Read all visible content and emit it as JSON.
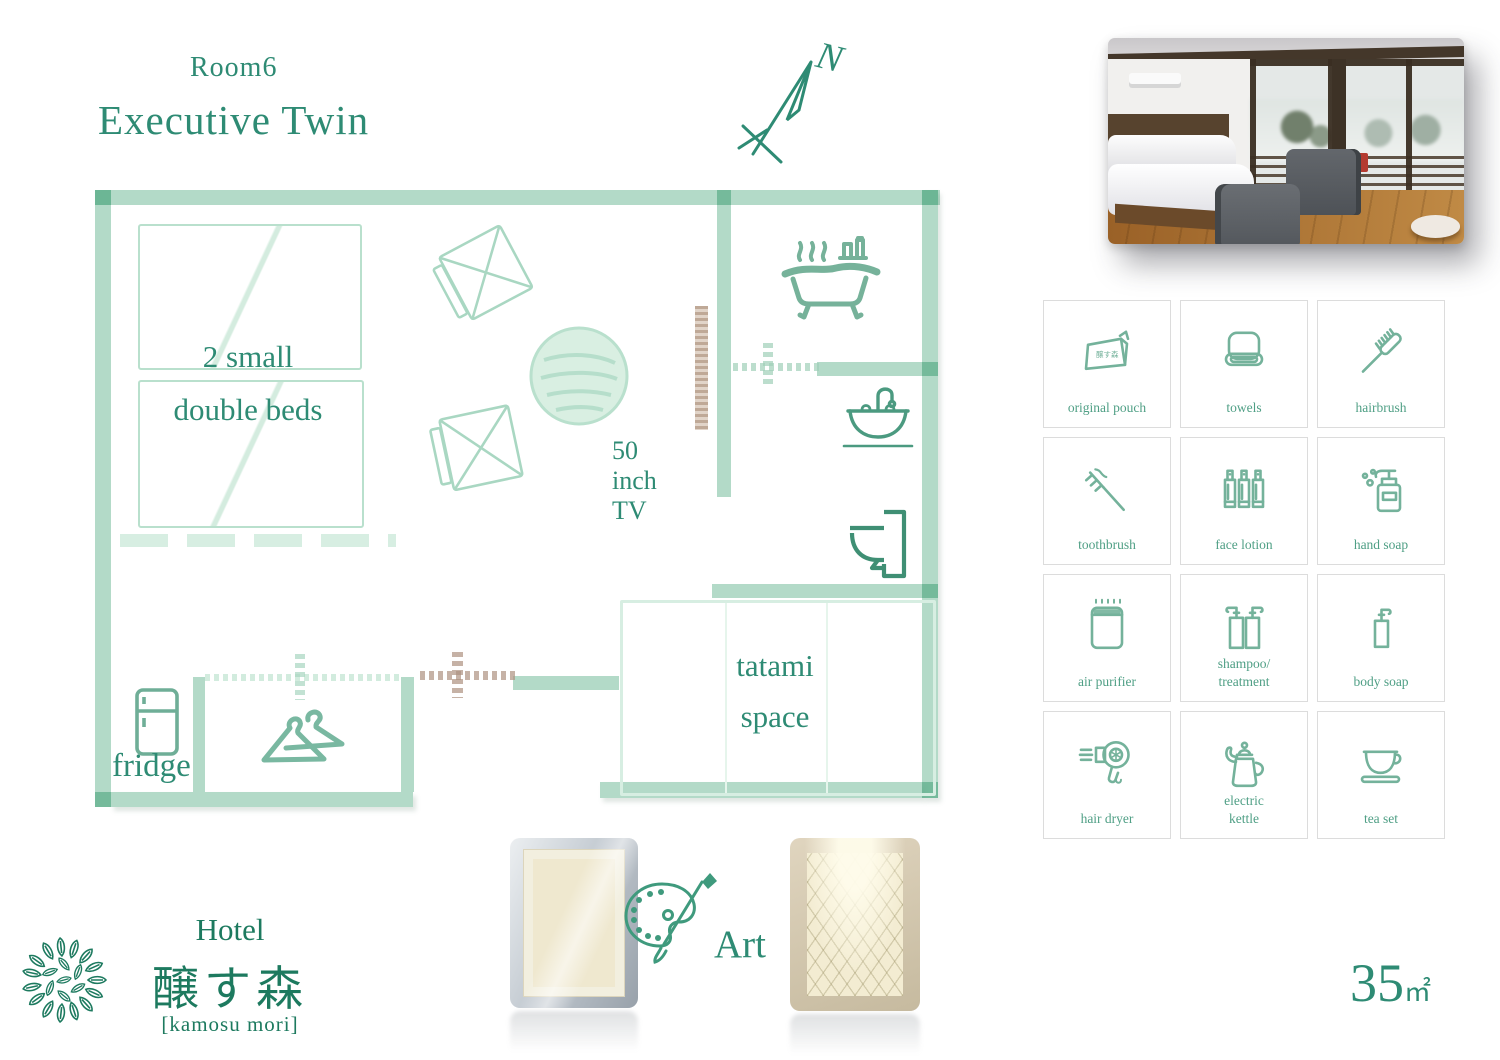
{
  "header": {
    "room_number": "Room6",
    "room_type": "Executive Twin"
  },
  "compass": {
    "north_label": "N"
  },
  "floorplan": {
    "beds_label": "2 small\ndouble beds",
    "tv_label": "50 inch TV",
    "tatami_label": "tatami\nspace",
    "fridge_label": "fridge"
  },
  "amenities": [
    {
      "label": "original pouch",
      "icon_text": "醸す森"
    },
    {
      "label": "towels"
    },
    {
      "label": "hairbrush"
    },
    {
      "label": "toothbrush"
    },
    {
      "label": "face lotion"
    },
    {
      "label": "hand soap"
    },
    {
      "label": "air purifier"
    },
    {
      "label": "shampoo/\ntreatment"
    },
    {
      "label": "body soap"
    },
    {
      "label": "hair dryer"
    },
    {
      "label": "electric\nkettle"
    },
    {
      "label": "tea set"
    }
  ],
  "art": {
    "label": "Art"
  },
  "area": {
    "value": "35",
    "unit": "㎡"
  },
  "logo": {
    "line1": "Hotel",
    "line2": "醸す森",
    "line3": "[kamosu mori]"
  },
  "colors": {
    "accent": "#2e8b74",
    "wall": "#74bb9a",
    "icon": "#74b29b",
    "amenity_label": "#4f9f85",
    "logo_green": "#1d7a5f"
  }
}
